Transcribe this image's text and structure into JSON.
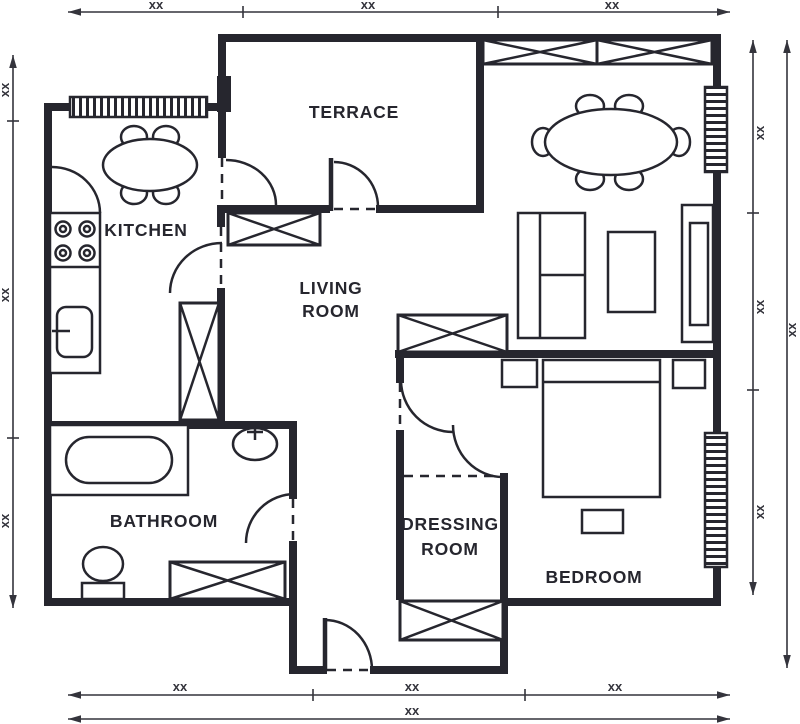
{
  "rooms": {
    "terrace": {
      "label": "TERRACE"
    },
    "kitchen": {
      "label": "KITCHEN"
    },
    "living_room": {
      "line1": "LIVING",
      "line2": "ROOM"
    },
    "bathroom": {
      "label": "BATHROOM"
    },
    "dressing_room": {
      "line1": "DRESSING",
      "line2": "ROOM"
    },
    "bedroom": {
      "label": "BEDROOM"
    }
  },
  "dims": {
    "top": [
      "xx",
      "xx",
      "xx"
    ],
    "left": [
      "xx",
      "xx",
      "xx"
    ],
    "right_inner": [
      "xx",
      "xx",
      "xx"
    ],
    "right_outer": [
      "xx"
    ],
    "bottom_inner": [
      "xx",
      "xx",
      "xx"
    ],
    "bottom_outer": [
      "xx"
    ]
  },
  "colors": {
    "wall": "#26262e",
    "dim": "#34343c",
    "bg": "#ffffff"
  }
}
